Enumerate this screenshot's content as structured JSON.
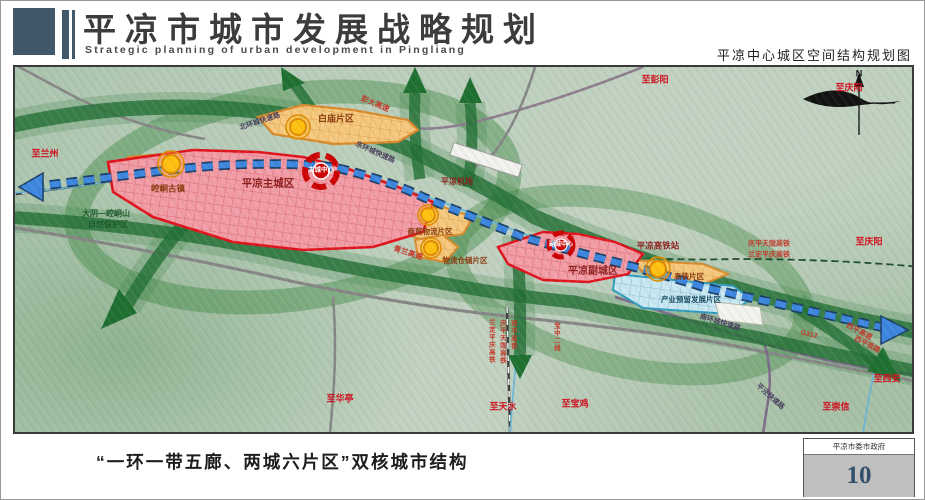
{
  "header": {
    "title": "平凉市城市发展战略规划",
    "subtitle": "Strategic planning of urban development in Pingliang",
    "map_title": "平凉中心城区空间结构规划图"
  },
  "compass": {
    "label": "N"
  },
  "zones": {
    "main_city": "平凉主城区",
    "main_center": "主城中心",
    "sub_city": "平凉副城区",
    "sub_center": "副城中心",
    "baimiao": "白庙片区",
    "kongtong": "崆峒古镇",
    "trade": "商贸物流片区",
    "storage": "物流仓储片区",
    "hsr_area": "高铁片区",
    "industry": "产业预留发展片区",
    "airport": "平凉机场",
    "hsr_station": "平凉高铁站",
    "reserve_line1": "大阴—崆峒山",
    "reserve_line2": "自然保护区"
  },
  "roads": {
    "north_ring": "北环城快速路",
    "east_ring": "东环城快速路",
    "south_ring": "南环城快速路",
    "pingjing": "平泾快速路",
    "pengda": "彭大高速",
    "qinglan": "青兰高速",
    "g312": "G312",
    "xiping_expwy": "西平高速",
    "xiping_rail": "西平铁路",
    "qptl_hsr": "庆平天陇高铁",
    "ldpq_hsr": "兰定平庆高铁",
    "xp_hsr": "西平高铁",
    "baozhong2": "宝中二线"
  },
  "directions": {
    "to_lanzhou": "至兰州",
    "to_pengyang": "至彭阳",
    "to_qingyang_n": "至庆阳",
    "to_qingyang_e": "至庆阳",
    "to_xian": "至西安",
    "to_chongxin": "至崇信",
    "to_baoji": "至宝鸡",
    "to_tianshui": "至天水",
    "to_huating": "至华亭"
  },
  "colors": {
    "core_red": "#e0131c",
    "zone_orange": "#f6c87d",
    "zone_blue": "#c9e8f2",
    "axis_blue": "#3c86e0",
    "corridor_green": "#2a7d3d",
    "node_yellow": "#ffc010"
  },
  "footer": {
    "caption": "“一环一带五廊、两城六片区”双核城市结构",
    "org": "平凉市委市政府",
    "page": "10"
  }
}
